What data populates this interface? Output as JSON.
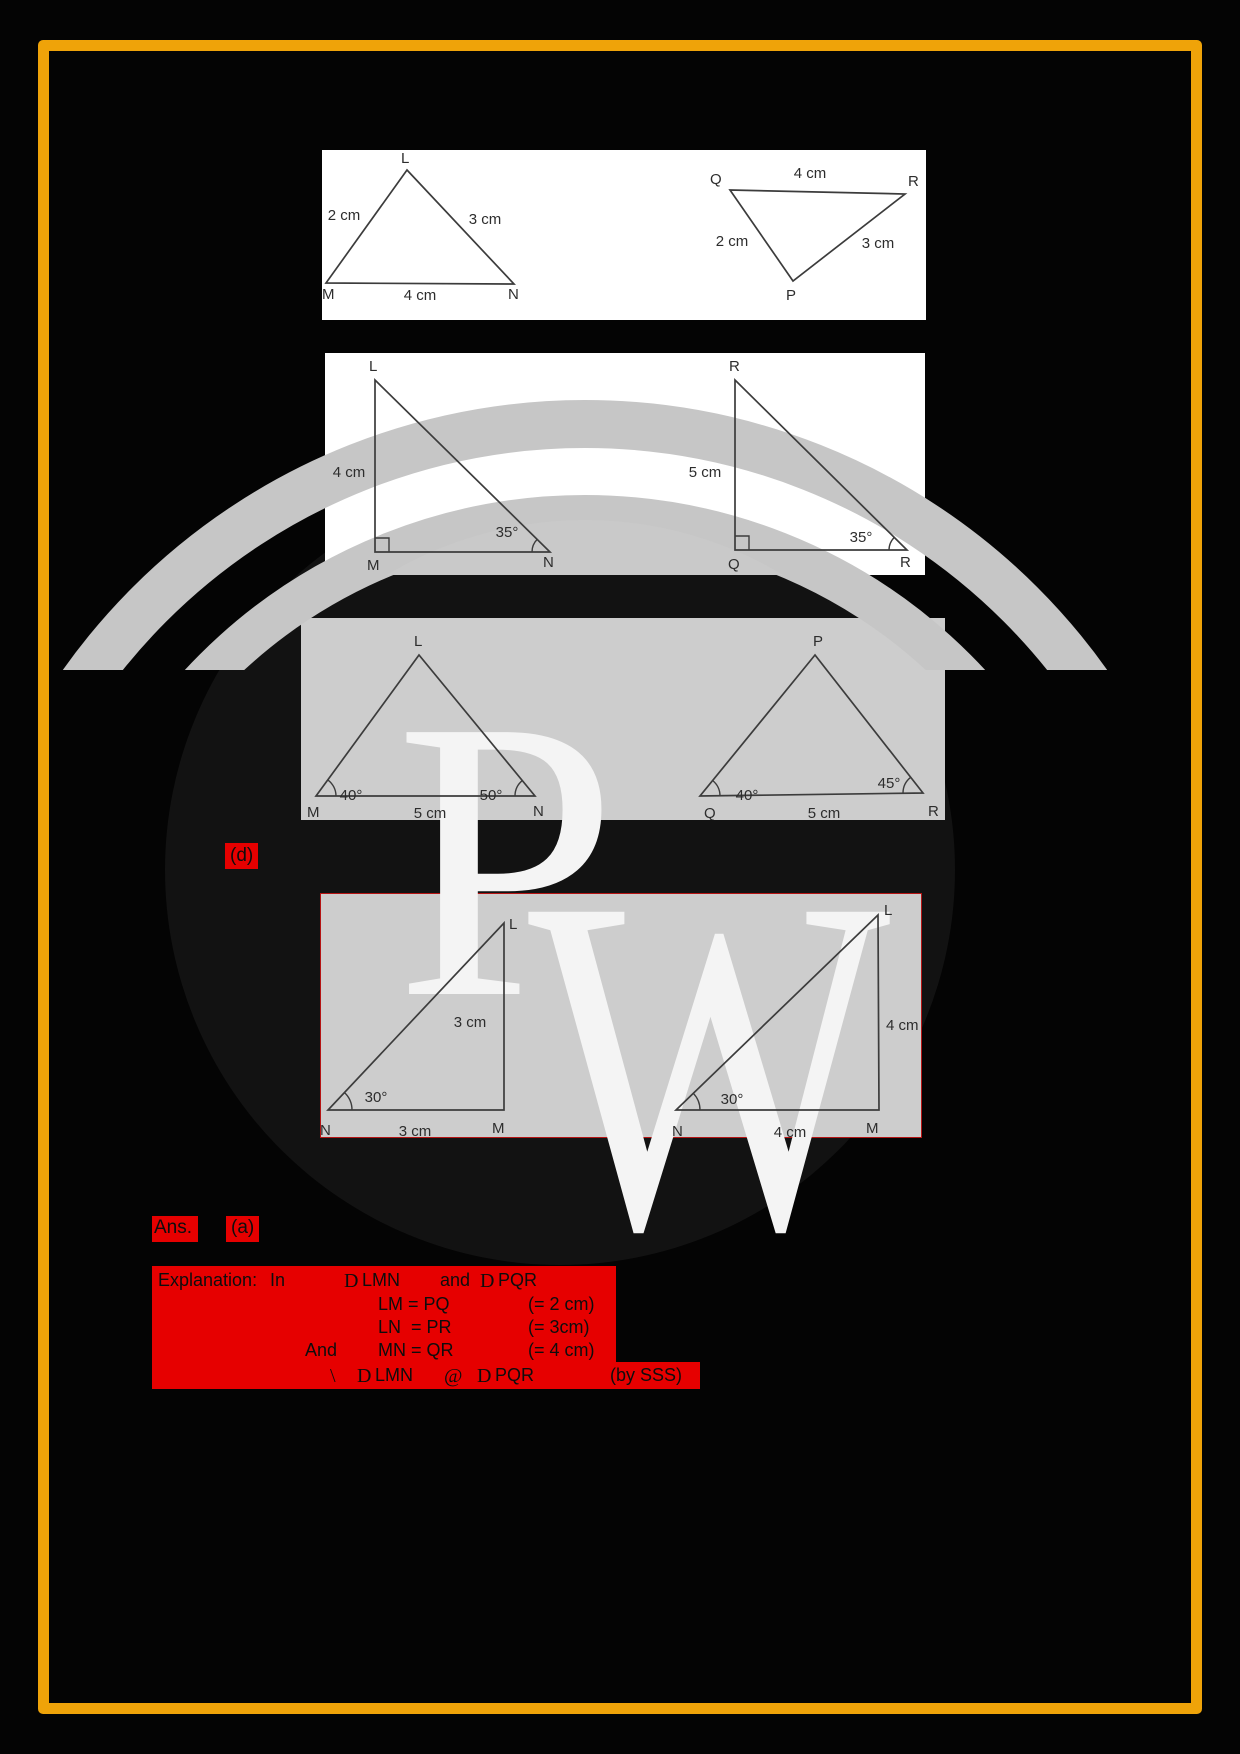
{
  "colors": {
    "highlight": "#e60000",
    "frame_orange": "#efa309",
    "panel_gray": "#cdcdcd",
    "line": "#3c3c3c",
    "page_bg": "#040404"
  },
  "watermark": {
    "letter1": "P",
    "letter2": "W"
  },
  "panels": {
    "p1": {
      "l": "L",
      "lm": "2 cm",
      "ln": "3 cm",
      "m": "M",
      "mn": "4 cm",
      "n": "N",
      "q": "Q",
      "qr": "4 cm",
      "r": "R",
      "qp": "2 cm",
      "pr": "3 cm",
      "p": "P"
    },
    "p2": {
      "l": "L",
      "lm": "4 cm",
      "angle_n": "35°",
      "m": "M",
      "n": "N",
      "r_top": "R",
      "rq": "5 cm",
      "angle_r": "35°",
      "q": "Q",
      "r": "R"
    },
    "p3": {
      "l": "L",
      "angle_m": "40°",
      "angle_n": "50°",
      "m": "M",
      "mn": "5 cm",
      "n": "N",
      "p": "P",
      "angle_q": "40°",
      "angle_r": "45°",
      "q": "Q",
      "qr": "5 cm",
      "r": "R"
    },
    "p4": {
      "l1": "L",
      "side1": "3 cm",
      "angle1": "30°",
      "n1": "N",
      "base1": "3 cm",
      "m1": "M",
      "l2": "L",
      "side2": "4 cm",
      "angle2": "30°",
      "n2": "N",
      "base2": "4 cm",
      "m2": "M"
    }
  },
  "option_d_label": "(d)",
  "answer": {
    "label": "Ans.",
    "value": "(a)"
  },
  "explanation": {
    "heading": "Explanation:",
    "in_word": "In",
    "delta": "D",
    "tri_lmn": "LMN",
    "and_word": "and",
    "tri_pqr": "PQR",
    "row2_left": "LM = PQ",
    "row2_right": "(= 2 cm)",
    "row3_left": "LN  = PR",
    "row3_right": "(= 3cm)",
    "row4_and": "And",
    "row4_left": "MN = QR",
    "row4_right": "(= 4 cm)",
    "therefore": "\\",
    "congruent": "@",
    "by_sss": "(by SSS)"
  }
}
